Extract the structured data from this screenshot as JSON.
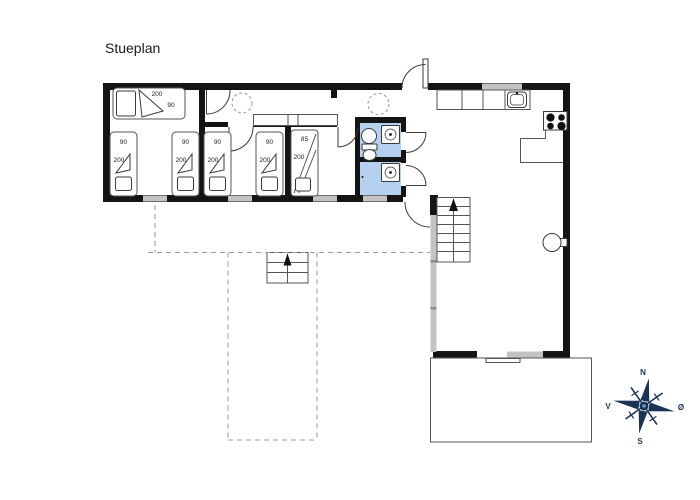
{
  "page": {
    "title": "Stueplan"
  },
  "plan": {
    "colors": {
      "wall": "#141414",
      "window": "#c3c3c3",
      "bath_floor": "#b4d1ef",
      "dashed": "#9a9a9a",
      "compass": "#1b3455"
    },
    "bed_labels": {
      "double_length": "200",
      "double_width": "90",
      "single_width": "90",
      "single_length": "200",
      "bunk_width": "85",
      "bunk_length": "200"
    },
    "compass": {
      "north": "N",
      "south": "S",
      "west": "V",
      "east": "Ø"
    }
  }
}
